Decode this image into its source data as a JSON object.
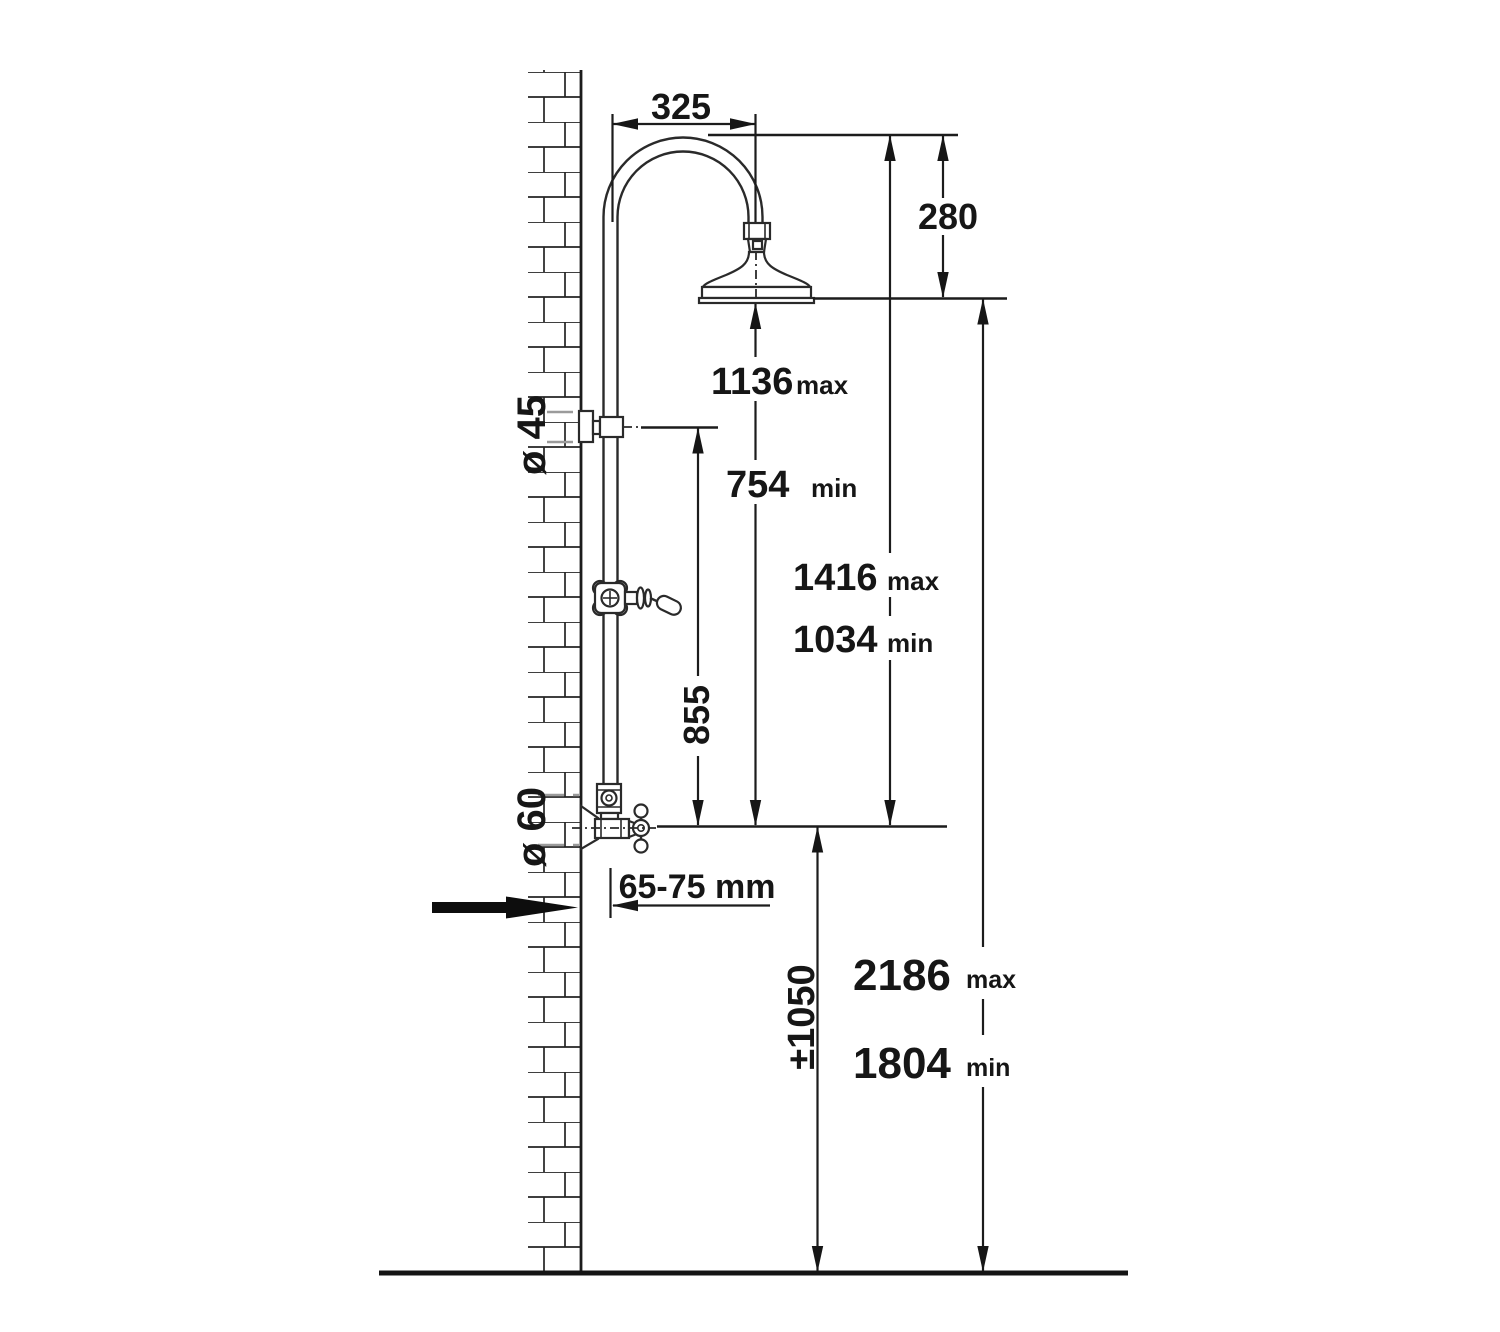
{
  "diagram": {
    "name": "shower-column-installation-dimensions",
    "units_note": "mm",
    "dims": {
      "arm_projection": {
        "value": "325"
      },
      "head_drop": {
        "value": "280"
      },
      "riser_travel_max": {
        "value": "1136",
        "suffix": "max"
      },
      "riser_travel_min": {
        "value": "754",
        "suffix": "min"
      },
      "head_top_max": {
        "value": "1416",
        "suffix": "max"
      },
      "head_top_min": {
        "value": "1034",
        "suffix": "min"
      },
      "diverter_height": {
        "value": "855"
      },
      "wall_offset": {
        "value": "65-75 mm"
      },
      "inlet_height": {
        "value": "±1050"
      },
      "overall_max": {
        "value": "2186",
        "suffix": "max"
      },
      "overall_min": {
        "value": "1804",
        "suffix": "min"
      },
      "bracket_diameter": {
        "value": "ø 45"
      },
      "inlet_diameter": {
        "value": "ø 60"
      }
    },
    "colors": {
      "ink": "#1c1c1c",
      "gray_dash": "#9b9b9b",
      "paper": "#ffffff"
    }
  }
}
